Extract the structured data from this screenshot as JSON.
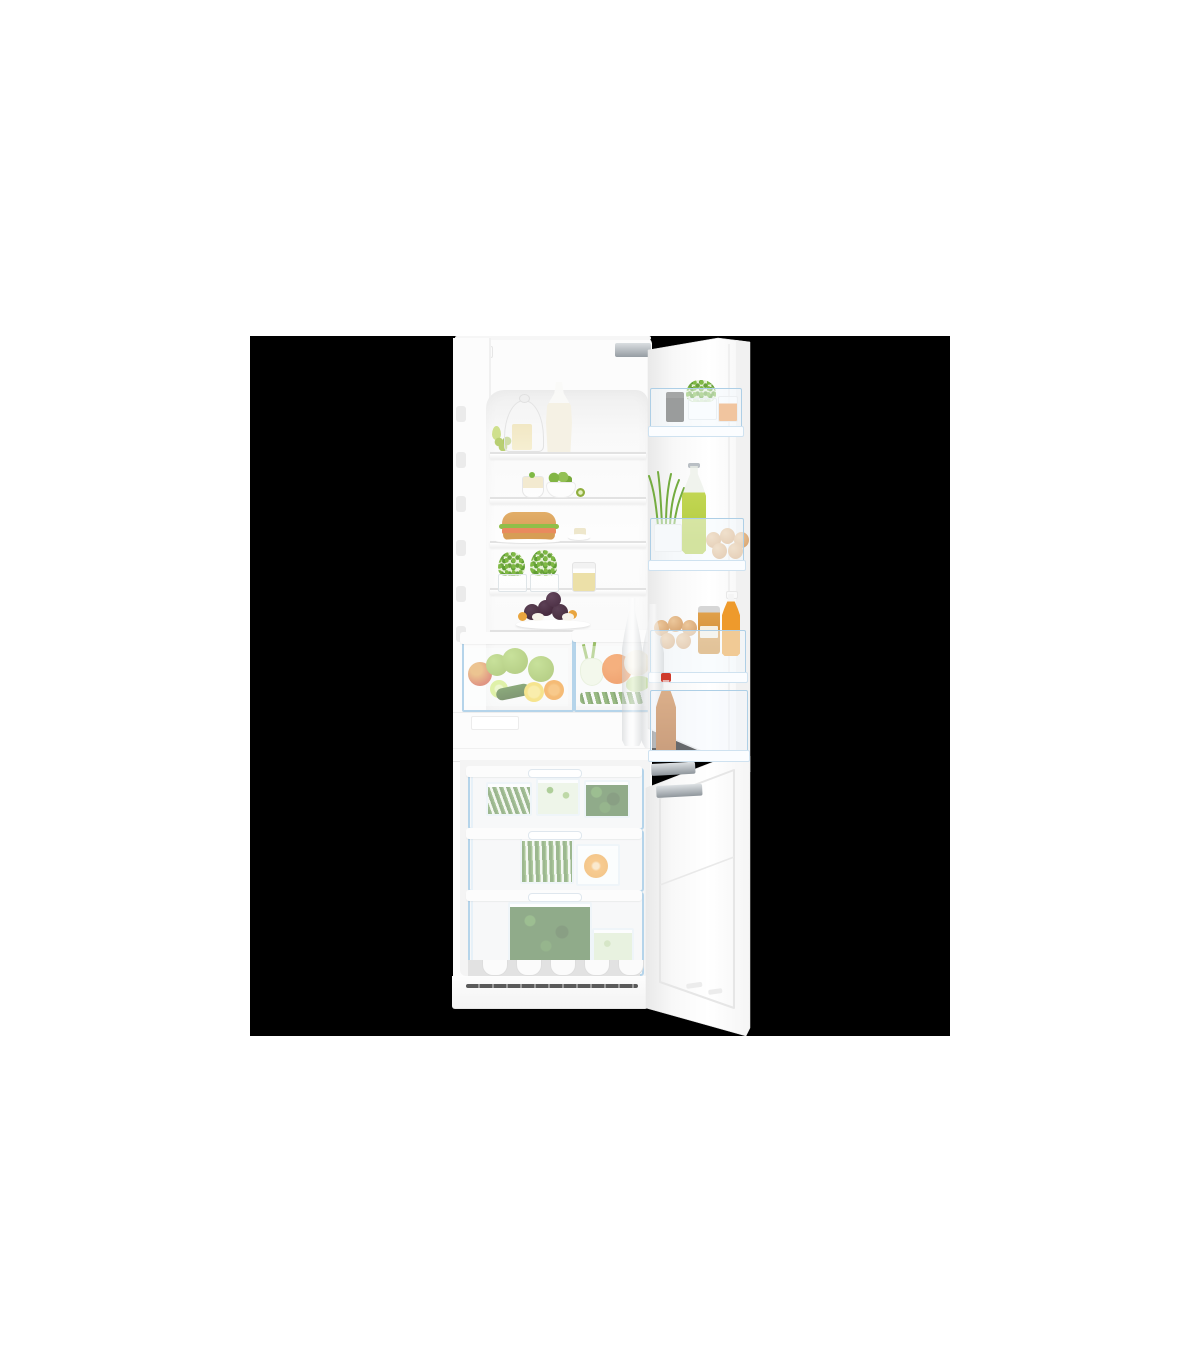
{
  "scene": {
    "subject": "Built-in fridge-freezer with both doors open, fully stocked with fresh food",
    "style": "e-commerce product photo, transparent background shown as black square centered on a white page",
    "page_background": "#ffffff",
    "image_backdrop": "#000000"
  },
  "appliance": {
    "category": "integrated fridge-freezer combination",
    "finish": "white",
    "doors": "two doors, hinged on the right, shown open",
    "fridge_shelf_items": [
      "glass cloche with butter block",
      "green grapes",
      "small green pear",
      "carafe of milk",
      "glass ramekin with dip",
      "white bowl with limes",
      "kiwi half",
      "burger with lettuce and salmon",
      "plate with butter pat",
      "two glass trays of garden cress",
      "jar of cheese cubes",
      "plate of plums, physalis and mozzarella"
    ],
    "crisper_left_items": [
      "green apples",
      "red apple",
      "lime",
      "cucumber",
      "lemon half",
      "orange half"
    ],
    "crisper_right_items": [
      "fennel bulb",
      "orange bell pepper",
      "cauliflower",
      "savoy cabbage",
      "green beans"
    ],
    "door_bin_items": [
      "jar of black pepper",
      "pot of cress",
      "cup of carrot sticks",
      "pot of wheatgrass",
      "swing-top bottle of green juice",
      "brown eggs",
      "jar of honey",
      "bottle of orange juice",
      "two tall glass water bottles",
      "swing-top bottle of iced tea with red cap"
    ],
    "freezer_drawer_items": [
      "box of green beans",
      "box of chopped leeks",
      "box of spinach",
      "box of long green beans",
      "box with orange slices",
      "large box of spinach leaves",
      "box of chopped celery"
    ]
  },
  "palette": {
    "page_bg": "#ffffff",
    "backdrop": "#000000",
    "body_white": "#fcfcfc",
    "seam": "#e6e6e6",
    "cavity_light": "#f8f8f8",
    "accent_blue": "#b5d4ea",
    "seal_blue": "#d7e7f3",
    "cress": "#6aa23c",
    "grass": "#74ac40",
    "leaf_dark": "#3a682b",
    "beans_green": "#4d7c33",
    "green_bright": "#8fbf49",
    "juice_green": "#c2d653",
    "lime": "#cde873",
    "lemon": "#f2d44a",
    "orange_fruit": "#f09222",
    "pepper_orange": "#ea6f1f",
    "carrot": "#ef9140",
    "oj": "#ee9a2c",
    "honey": "#e0a04a",
    "amber": "#c97a35",
    "cap_red": "#cf3b2c",
    "egg_brown": "#d9a876",
    "cheese": "#ecda9a",
    "plum": "#4a3040",
    "cauliflower": "#f4eedd",
    "cabbage": "#b9d883",
    "fennel": "#eef4e0",
    "bun": "#dca45f",
    "salmon": "#e98a5e",
    "milk": "#f5f1e4",
    "metal": "#9aa0a4",
    "dark_jar": "#403e3a",
    "vent": "#5a5a5a"
  }
}
